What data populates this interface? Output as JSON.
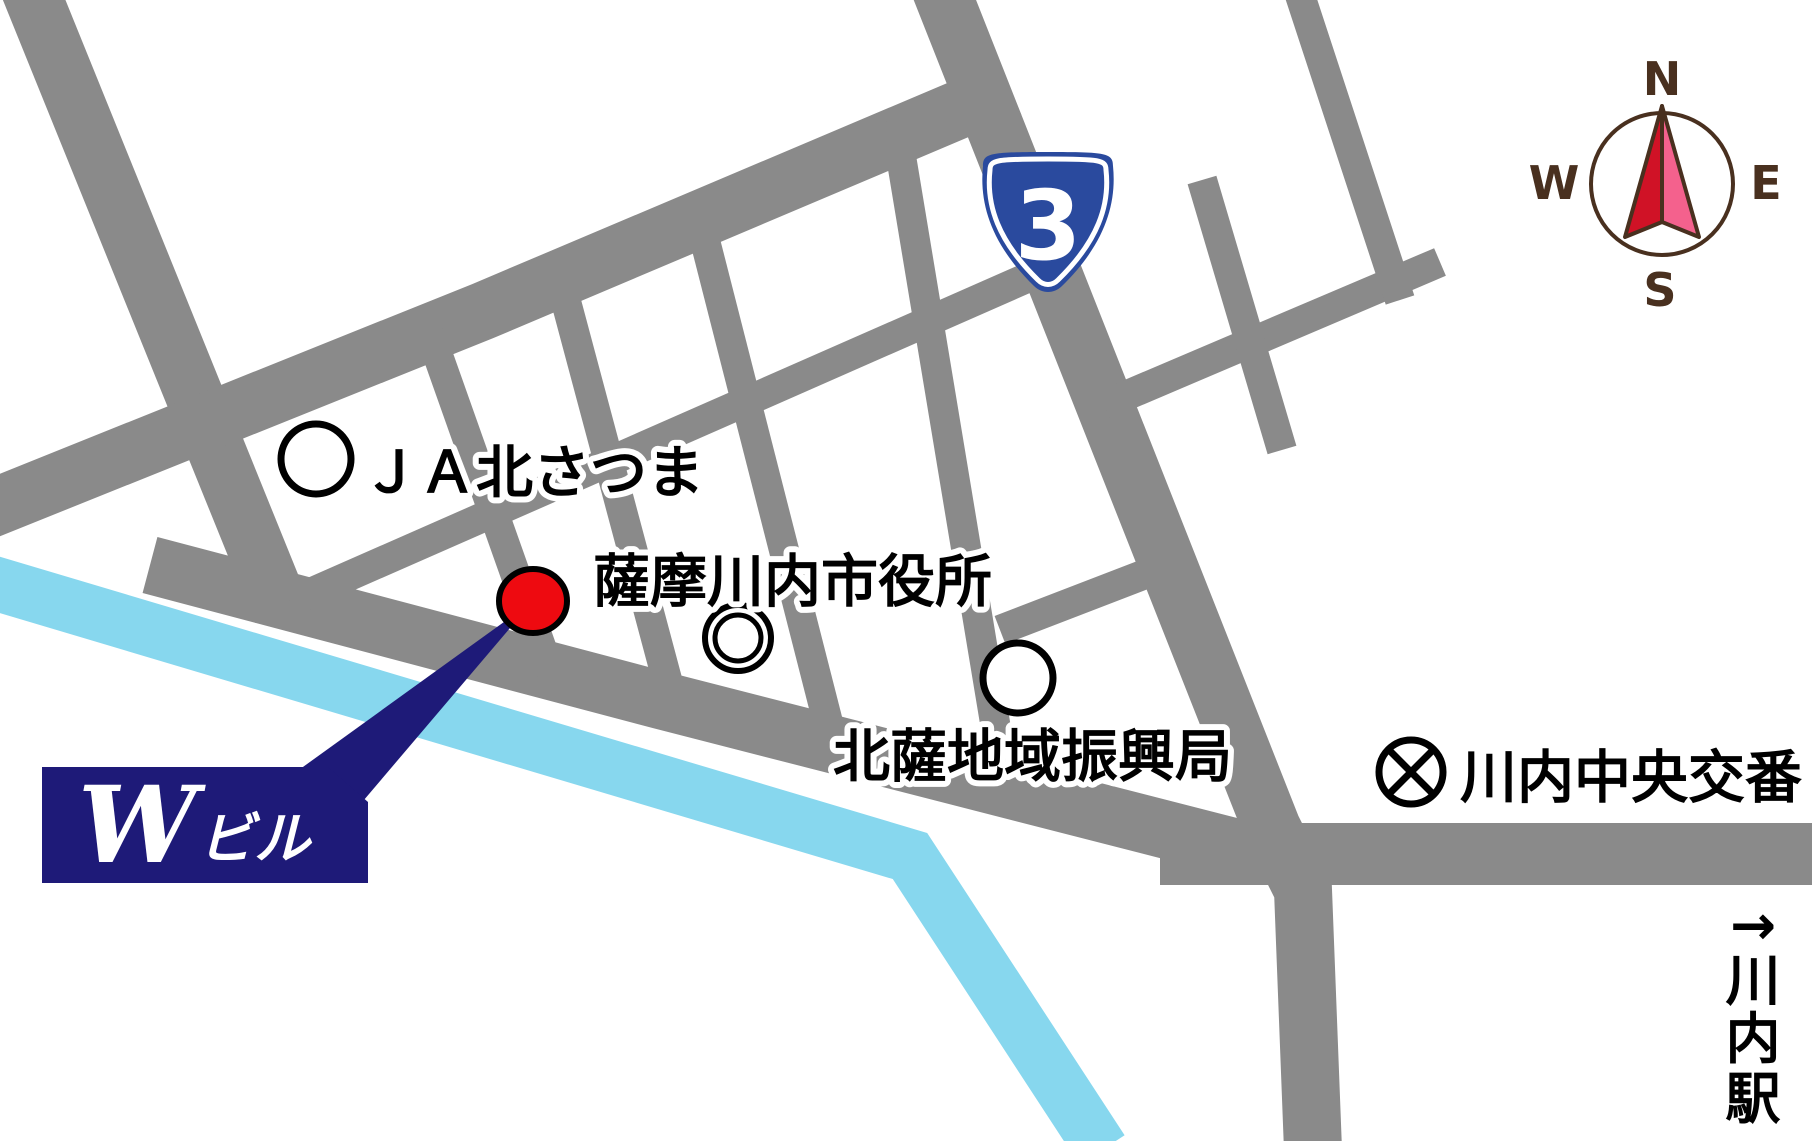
{
  "map": {
    "landmarks": [
      {
        "label": "ＪＡ北さつま",
        "marker": "circle"
      },
      {
        "label": "薩摩川内市役所",
        "marker": "double-circle"
      },
      {
        "label": "北薩地域振興局",
        "marker": "circle"
      },
      {
        "label": "川内中央交番",
        "marker": "circle-x"
      }
    ],
    "target": {
      "name_initial": "W",
      "name_suffix": "ビル"
    },
    "route_shield": {
      "number": "3"
    },
    "station": {
      "arrow": "→",
      "chars": [
        "川",
        "内",
        "駅"
      ]
    },
    "compass": {
      "north": "N",
      "south": "S",
      "east": "E",
      "west": "W"
    },
    "colors": {
      "road": "#8a8a8a",
      "river": "#87d7ee",
      "marker_red": "#ee0a10",
      "navy": "#1e1a78",
      "shield_blue": "#2a4a9e",
      "compass_brown": "#49301f",
      "needle_red": "#d01226",
      "needle_pink": "#f4618d",
      "label_text": "#000000",
      "halo": "#ffffff"
    }
  }
}
